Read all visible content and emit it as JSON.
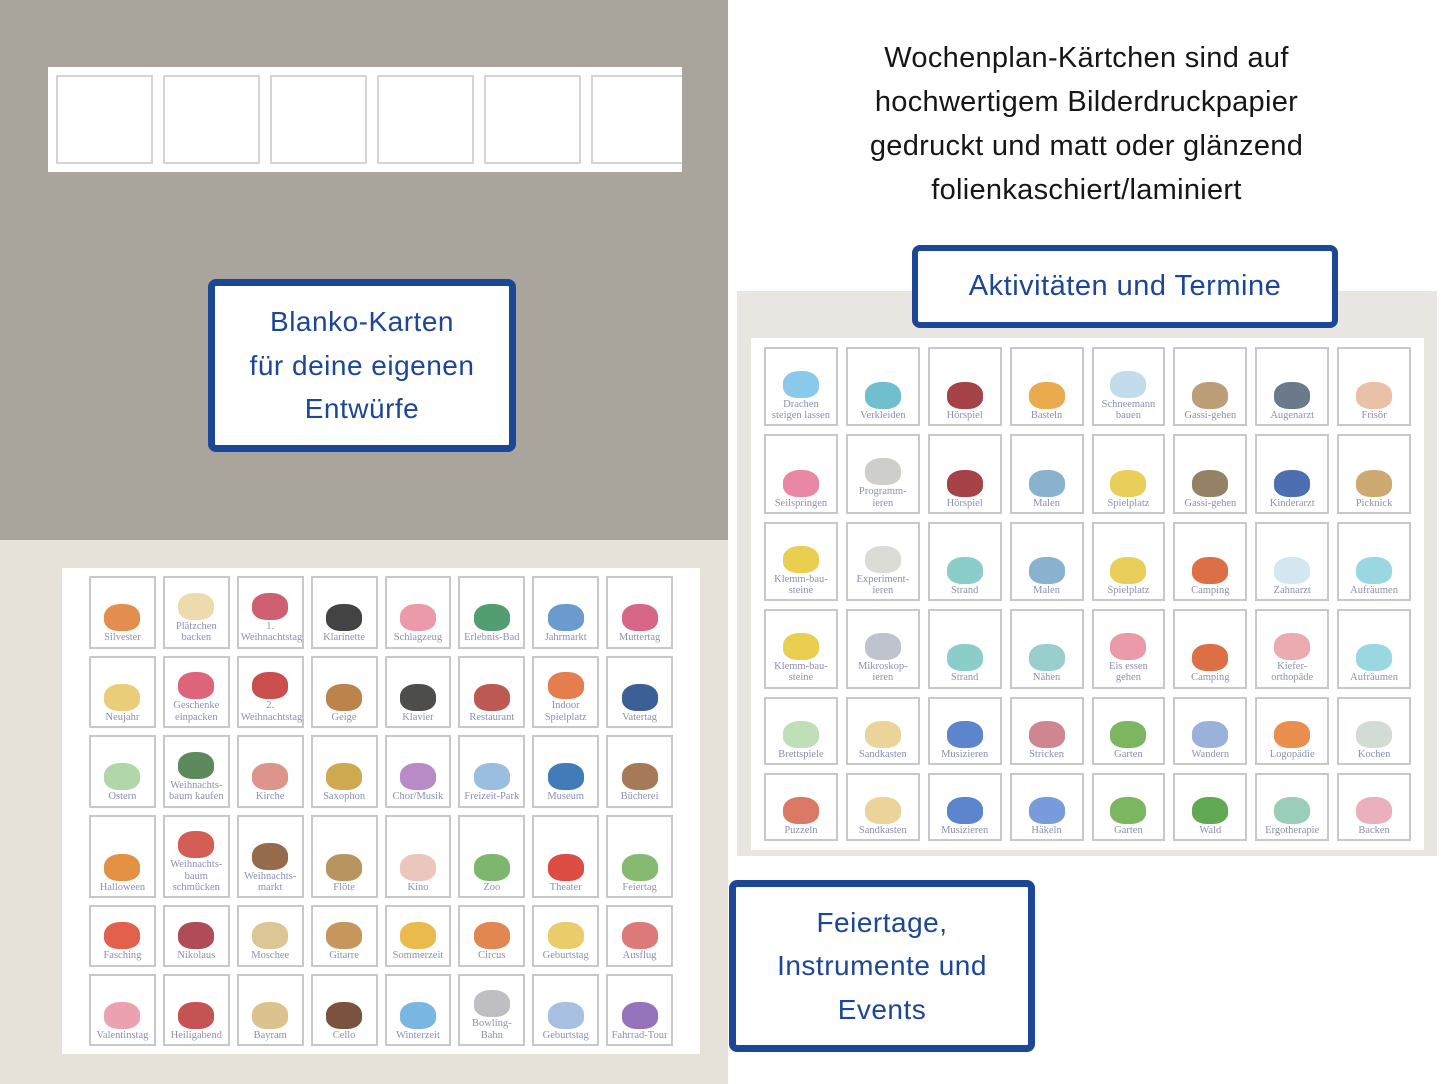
{
  "right_header": {
    "text": "Wochenplan-Kärtchen sind auf\nhochwertigem Bilderdruckpapier\ngedruckt und matt oder glänzend\nfolienkaschiert/laminiert"
  },
  "boxes": {
    "blanko": {
      "text": "Blanko-Karten\nfür deine eigenen\nEntwürfe"
    },
    "aktivitaeten": {
      "label": "Aktivitäten und Termine"
    },
    "feiertage": {
      "text": "Feiertage,\nInstrumente und\nEvents"
    }
  },
  "colors": {
    "accent_blue": "#1c4696",
    "taupe_panel": "#a9a59d",
    "beige_panel": "#e6e1d9",
    "gray_panel": "#e9e5e0",
    "card_border": "#c8c8c8",
    "card_label": "#8b90b0"
  },
  "blank_cards": {
    "count": 6
  },
  "left_grid": {
    "title": "Feiertage, Instrumente und Events",
    "cards": [
      {
        "label": "Silvester",
        "icon": "fireworks",
        "color": "#e0823c"
      },
      {
        "label": "Plätzchen backen",
        "icon": "cookie-dough",
        "color": "#ecd7a4"
      },
      {
        "label": "1. Weihnachtstag",
        "icon": "gift-pile",
        "color": "#c94f63"
      },
      {
        "label": "Klarinette",
        "icon": "clarinet",
        "color": "#2f2f2f"
      },
      {
        "label": "Schlagzeug",
        "icon": "drum-kit",
        "color": "#e88fa0"
      },
      {
        "label": "Erlebnis-Bad",
        "icon": "water-slide",
        "color": "#3f9263"
      },
      {
        "label": "Jahrmarkt",
        "icon": "ferris-wheel",
        "color": "#5b8fc9"
      },
      {
        "label": "Muttertag",
        "icon": "best-mom-lettering",
        "color": "#d4577a"
      },
      {
        "label": "Neujahr",
        "icon": "calendar-jan-1",
        "color": "#e8c86a"
      },
      {
        "label": "Geschenke einpacken",
        "icon": "ribbon-scissors",
        "color": "#d9536b"
      },
      {
        "label": "2. Weihnachtstag",
        "icon": "car-with-gifts",
        "color": "#c43b38"
      },
      {
        "label": "Geige",
        "icon": "violin",
        "color": "#b5763a"
      },
      {
        "label": "Klavier",
        "icon": "piano",
        "color": "#3a3a35"
      },
      {
        "label": "Restaurant",
        "icon": "restaurant-building",
        "color": "#b5473f"
      },
      {
        "label": "Indoor Spielplatz",
        "icon": "indoor-slide",
        "color": "#e1703c"
      },
      {
        "label": "Vatertag",
        "icon": "awesome-dad-lettering",
        "color": "#274e8d"
      },
      {
        "label": "Ostern",
        "icon": "easter-bush",
        "color": "#a9d1a0"
      },
      {
        "label": "Weihnachts-baum kaufen",
        "icon": "christmas-tree",
        "color": "#4a7d4a"
      },
      {
        "label": "Kirche",
        "icon": "church",
        "color": "#d98a7e"
      },
      {
        "label": "Saxophon",
        "icon": "saxophone",
        "color": "#c9a03c"
      },
      {
        "label": "Chor/Musik",
        "icon": "microphone",
        "color": "#b07ec1"
      },
      {
        "label": "Freizeit-Park",
        "icon": "roller-coaster",
        "color": "#8fb6dd"
      },
      {
        "label": "Museum",
        "icon": "museum-building",
        "color": "#2f6bb0"
      },
      {
        "label": "Bücherei",
        "icon": "bookshelf",
        "color": "#9c6b44"
      },
      {
        "label": "Halloween",
        "icon": "pumpkins",
        "color": "#e2852f"
      },
      {
        "label": "Weihnachts-baum schmücken",
        "icon": "christmas-ornaments",
        "color": "#cf4b42"
      },
      {
        "label": "Weihnachts-markt",
        "icon": "christmas-market",
        "color": "#8a5a3a"
      },
      {
        "label": "Flöte",
        "icon": "recorder-flute",
        "color": "#b08a4f"
      },
      {
        "label": "Kino",
        "icon": "popcorn",
        "color": "#e8c0b5"
      },
      {
        "label": "Zoo",
        "icon": "zoo-gate",
        "color": "#6fae5c"
      },
      {
        "label": "Theater",
        "icon": "theater-curtain",
        "color": "#d93a30"
      },
      {
        "label": "Feiertag",
        "icon": "lucky-clover",
        "color": "#79b361"
      },
      {
        "label": "Fasching",
        "icon": "carnival-mask",
        "color": "#e04f3a"
      },
      {
        "label": "Nikolaus",
        "icon": "christmas-stocking",
        "color": "#a63845"
      },
      {
        "label": "Moschee",
        "icon": "mosque",
        "color": "#d8c08a"
      },
      {
        "label": "Gitarre",
        "icon": "guitar",
        "color": "#c08b4a"
      },
      {
        "label": "Sommerzeit",
        "icon": "sun-and-clock",
        "color": "#e8b33c"
      },
      {
        "label": "Circus",
        "icon": "circus-tent",
        "color": "#e07a3f"
      },
      {
        "label": "Geburtstag",
        "icon": "birthday-cake",
        "color": "#e8c85a"
      },
      {
        "label": "Ausflug",
        "icon": "red-bus",
        "color": "#d96a6a"
      },
      {
        "label": "Valentinstag",
        "icon": "lovebirds",
        "color": "#e898a8"
      },
      {
        "label": "Heiligabend",
        "icon": "santa-sleigh",
        "color": "#bf4040"
      },
      {
        "label": "Bayram",
        "icon": "crescent-mosque",
        "color": "#d8bb80"
      },
      {
        "label": "Cello",
        "icon": "cello",
        "color": "#6b3f2a"
      },
      {
        "label": "Winterzeit",
        "icon": "snowflake-clock",
        "color": "#6aaede"
      },
      {
        "label": "Bowling-Bahn",
        "icon": "bowling-pins",
        "color": "#b8b8bc"
      },
      {
        "label": "Geburtstag",
        "icon": "gift-box",
        "color": "#9db8dd"
      },
      {
        "label": "Fahrrad-Tour",
        "icon": "tandem-bike",
        "color": "#8a63b5"
      }
    ]
  },
  "right_grid": {
    "title": "Aktivitäten und Termine",
    "cards": [
      {
        "label": "Drachen steigen lassen",
        "icon": "kite",
        "color": "#7cc3e8"
      },
      {
        "label": "Verkleiden",
        "icon": "dress-up-mirror",
        "color": "#5fb8c9"
      },
      {
        "label": "Hörspiel",
        "icon": "radio",
        "color": "#9c2f35"
      },
      {
        "label": "Basteln",
        "icon": "scissors-and-glue",
        "color": "#e8a23c"
      },
      {
        "label": "Schneemann bauen",
        "icon": "snowman",
        "color": "#bcd8ea"
      },
      {
        "label": "Gassi-gehen",
        "icon": "woman-with-dog",
        "color": "#b5946a"
      },
      {
        "label": "Augenarzt",
        "icon": "eye-chart",
        "color": "#5a6b7d"
      },
      {
        "label": "Frisör",
        "icon": "comb-and-scissors",
        "color": "#e8b9a0"
      },
      {
        "label": "Seilspringen",
        "icon": "jump-rope-girl",
        "color": "#e87a9a"
      },
      {
        "label": "Programm-ieren",
        "icon": "retro-computer",
        "color": "#c9c9c4"
      },
      {
        "label": "Hörspiel",
        "icon": "radio",
        "color": "#9c2f35"
      },
      {
        "label": "Malen",
        "icon": "paint-box",
        "color": "#7da8c9"
      },
      {
        "label": "Spielplatz",
        "icon": "playground",
        "color": "#e8c94a"
      },
      {
        "label": "Gassi-gehen",
        "icon": "boy-with-dog",
        "color": "#8a7355"
      },
      {
        "label": "Kinderarzt",
        "icon": "pediatrician",
        "color": "#3a5fa8"
      },
      {
        "label": "Picknick",
        "icon": "picnic-basket",
        "color": "#c9a063"
      },
      {
        "label": "Klemm-bau-steine",
        "icon": "building-bricks",
        "color": "#e8c93c"
      },
      {
        "label": "Experiment-ieren",
        "icon": "kids-lab-coats",
        "color": "#d8d8d3"
      },
      {
        "label": "Strand",
        "icon": "beach-surfer",
        "color": "#7ec9c3"
      },
      {
        "label": "Malen",
        "icon": "paint-box",
        "color": "#7da8c9"
      },
      {
        "label": "Spielplatz",
        "icon": "playground",
        "color": "#e8c94a"
      },
      {
        "label": "Camping",
        "icon": "camping-tent",
        "color": "#d95f33"
      },
      {
        "label": "Zahnarzt",
        "icon": "tooth-and-mirror",
        "color": "#cfe3ee"
      },
      {
        "label": "Aufräumen",
        "icon": "tidy-room",
        "color": "#8fd3dd"
      },
      {
        "label": "Klemm-bau-steine",
        "icon": "building-bricks",
        "color": "#e8c93c"
      },
      {
        "label": "Mikroskop-ieren",
        "icon": "microscope",
        "color": "#b8bcc9"
      },
      {
        "label": "Strand",
        "icon": "beach-surfer",
        "color": "#7ec9c3"
      },
      {
        "label": "Nähen",
        "icon": "sewing-machine",
        "color": "#8fc9c9"
      },
      {
        "label": "Eis essen gehen",
        "icon": "ice-cream-cone",
        "color": "#e88fa0"
      },
      {
        "label": "Camping",
        "icon": "camping-tent",
        "color": "#d95f33"
      },
      {
        "label": "Kiefer-orthopäde",
        "icon": "braces",
        "color": "#e8a3a8"
      },
      {
        "label": "Aufräumen",
        "icon": "tidy-room",
        "color": "#8fd3dd"
      },
      {
        "label": "Brettspiele",
        "icon": "board-game",
        "color": "#b8dbb0"
      },
      {
        "label": "Sandkasten",
        "icon": "sand-bucket-shovel",
        "color": "#e8cf8f"
      },
      {
        "label": "Musizieren",
        "icon": "music-notes",
        "color": "#4a78c9"
      },
      {
        "label": "Stricken",
        "icon": "knitting",
        "color": "#c97a85"
      },
      {
        "label": "Garten",
        "icon": "vegetable-basket",
        "color": "#6fae4f"
      },
      {
        "label": "Wandern",
        "icon": "hiking-map",
        "color": "#8fa8d8"
      },
      {
        "label": "Logopädie",
        "icon": "speech-therapy",
        "color": "#e8823c"
      },
      {
        "label": "Kochen",
        "icon": "cooking-pot",
        "color": "#cdd8cd"
      },
      {
        "label": "Puzzeln",
        "icon": "puzzle-pieces",
        "color": "#d86a55"
      },
      {
        "label": "Sandkasten",
        "icon": "sand-bucket-shovel",
        "color": "#e8cf8f"
      },
      {
        "label": "Musizieren",
        "icon": "music-notes",
        "color": "#4a78c9"
      },
      {
        "label": "Häkeln",
        "icon": "crochet-yarn",
        "color": "#6a8fd8"
      },
      {
        "label": "Garten",
        "icon": "vegetable-basket",
        "color": "#6fae4f"
      },
      {
        "label": "Wald",
        "icon": "forest-trees",
        "color": "#4f9e3f"
      },
      {
        "label": "Ergotherapie",
        "icon": "ergo-therapy",
        "color": "#8fc9b0"
      },
      {
        "label": "Backen",
        "icon": "stand-mixer",
        "color": "#e8a8b5"
      }
    ]
  }
}
